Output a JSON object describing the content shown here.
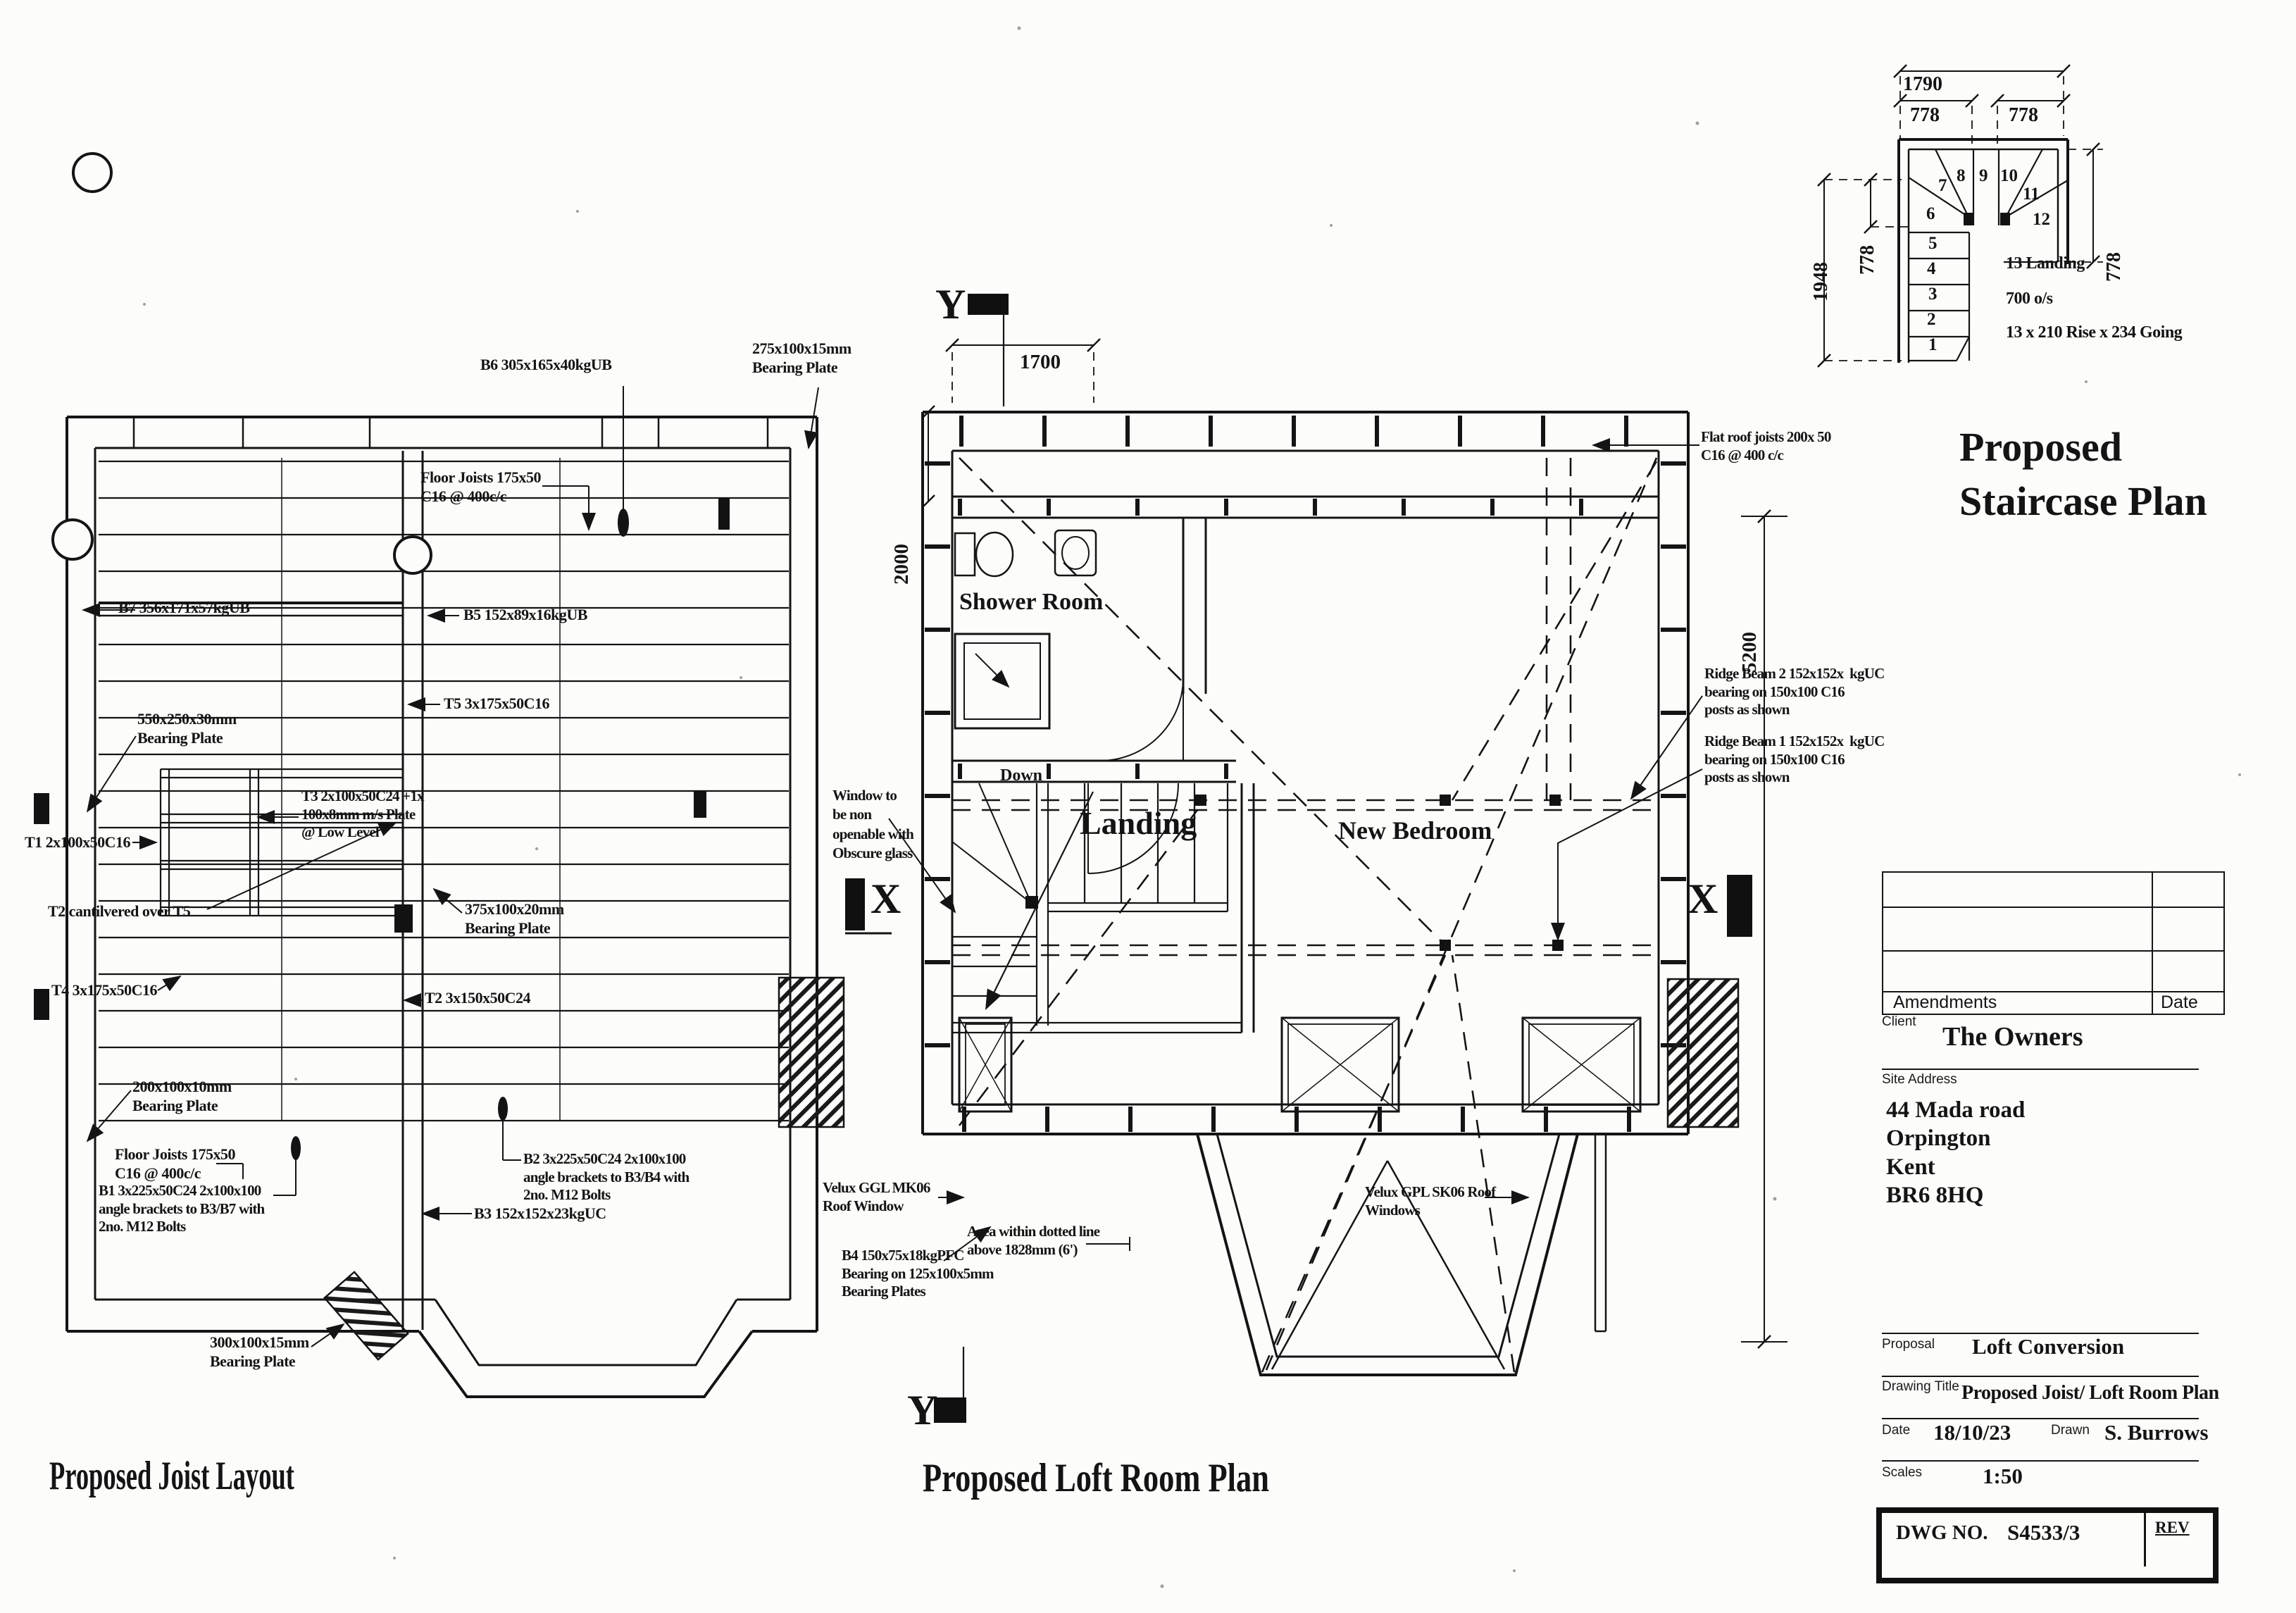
{
  "sheet": {
    "titles": {
      "joist_layout": "Proposed Joist Layout",
      "loft_room": "Proposed Loft Room Plan",
      "staircase": "Proposed Staircase Plan"
    }
  },
  "joist_plan": {
    "labels": {
      "b6": "B6 305x165x40kgUB",
      "bearing_plate_275": "275x100x15mm\nBearing Plate",
      "floor_joists_top": "Floor Joists 175x50\nC16 @ 400c/c",
      "b7": "B7 356x171x57kgUB",
      "b5": "B5 152x89x16kgUB",
      "t5": "T5 3x175x50C16",
      "bearing_plate_550": "550x250x30mm\nBearing Plate",
      "t3": "T3 2x100x50C24 +1x\n100x8mm m/s Plate\n@ Low Level",
      "t1": "T1 2x100x50C16",
      "bearing_plate_375": "375x100x20mm\nBearing Plate",
      "t2_cantilever": "T2 cantilvered over T5",
      "t2": "T2 3x150x50C24",
      "t4": "T4 3x175x50C16",
      "bearing_plate_200": "200x100x10mm\nBearing Plate",
      "floor_joists_bottom": "Floor Joists 175x50\nC16 @ 400c/c",
      "b1": "B1 3x225x50C24 2x100x100\nangle brackets to B3/B7 with\n2no. M12 Bolts",
      "b2": "B2 3x225x50C24 2x100x100\nangle brackets to B3/B4 with\n2no. M12 Bolts",
      "b3": "B3 152x152x23kgUC",
      "bearing_plate_300": "300x100x15mm\nBearing Plate"
    }
  },
  "loft_plan": {
    "rooms": {
      "shower_room": "Shower Room",
      "landing": "Landing",
      "new_bedroom": "New Bedroom",
      "down": "Down"
    },
    "labels": {
      "flat_roof_joists": "Flat roof joists 200x 50\nC16 @ 400 c/c",
      "ridge_beam_2": "Ridge Beam 2 152x152x  kgUC\nbearing on 150x100 C16\nposts as shown",
      "ridge_beam_1": "Ridge Beam 1 152x152x  kgUC\nbearing on 150x100 C16\nposts as shown",
      "window_note": "Window to\nbe non\nopenable with\nObscure glass",
      "velux_ggl": "Velux GGL MK06\nRoof Window",
      "b4": "B4 150x75x18kgPFC\nBearing on 125x100x5mm\nBearing Plates",
      "area_note": "Area within dotted line\nabove 1828mm (6')",
      "velux_gpl": "Velux GPL SK06 Roof\nWindows"
    },
    "dimensions": {
      "width_1700": "1700",
      "depth_2000": "2000",
      "length_5200": "5200"
    },
    "markers": {
      "x": "X",
      "y": "Y"
    }
  },
  "staircase_plan": {
    "dimensions": {
      "overall_1790": "1790",
      "top_left_778": "778",
      "top_right_778": "778",
      "height_1948": "1948",
      "side_778": "778",
      "right_778": "778"
    },
    "steps": [
      "1",
      "2",
      "3",
      "4",
      "5",
      "6",
      "7",
      "8",
      "9",
      "10",
      "11",
      "12"
    ],
    "notes": {
      "landing": "13 Landing",
      "overall": "700 o/s",
      "rise_going": "13 x 210 Rise x 234 Going"
    }
  },
  "title_block": {
    "amendments": {
      "header": "Amendments",
      "date_header": "Date"
    },
    "client": {
      "label": "Client",
      "value": "The Owners"
    },
    "site_address": {
      "label": "Site Address",
      "value": "44 Mada road\nOrpington\nKent\nBR6 8HQ"
    },
    "proposal": {
      "label": "Proposal",
      "value": "Loft Conversion"
    },
    "drawing_title": {
      "label": "Drawing Title",
      "value": "Proposed Joist/ Loft Room Plan"
    },
    "date": {
      "label": "Date",
      "value": "18/10/23"
    },
    "drawn": {
      "label": "Drawn",
      "value": "S. Burrows"
    },
    "scales": {
      "label": "Scales",
      "value": "1:50"
    },
    "dwg": {
      "label": "DWG NO.",
      "value": "S4533/3",
      "rev_label": "REV"
    }
  }
}
